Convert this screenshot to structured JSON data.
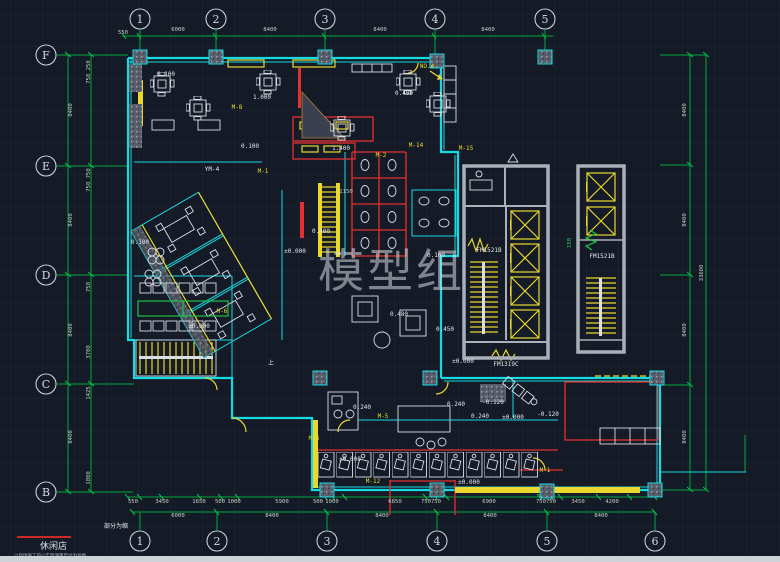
{
  "meta": {
    "watermark": "模型组",
    "note_bottom": "部分为缩",
    "title": "休闲店",
    "subtitle": "以现场施工前以实际测量尺寸为准图",
    "colors": {
      "background": "#141a26",
      "dim_green": "#00a83c",
      "wall_cyan": "#16dbe3",
      "fixture_yellow": "#ead82e",
      "accent_red": "#e23131",
      "text_white": "#e3e7ee"
    }
  },
  "axes": {
    "top": [
      {
        "label": "1",
        "x": 140
      },
      {
        "label": "2",
        "x": 216
      },
      {
        "label": "3",
        "x": 325
      },
      {
        "label": "4",
        "x": 435
      },
      {
        "label": "5",
        "x": 545
      }
    ],
    "bottom": [
      {
        "label": "1",
        "x": 140
      },
      {
        "label": "2",
        "x": 217
      },
      {
        "label": "3",
        "x": 327
      },
      {
        "label": "4",
        "x": 437
      },
      {
        "label": "5",
        "x": 547
      },
      {
        "label": "6",
        "x": 655
      }
    ],
    "left": [
      {
        "label": "F",
        "y": 55
      },
      {
        "label": "E",
        "y": 166
      },
      {
        "label": "D",
        "y": 275
      },
      {
        "label": "C",
        "y": 384
      },
      {
        "label": "B",
        "y": 492
      }
    ]
  },
  "dim_texts": [
    {
      "t": "550",
      "x": 123,
      "y": 34
    },
    {
      "t": "6000",
      "x": 178,
      "y": 31
    },
    {
      "t": "8400",
      "x": 270,
      "y": 31
    },
    {
      "t": "8400",
      "x": 380,
      "y": 31
    },
    {
      "t": "8400",
      "x": 488,
      "y": 31
    },
    {
      "t": "8400",
      "x": 686,
      "y": 110,
      "r": -90
    },
    {
      "t": "8400",
      "x": 686,
      "y": 220,
      "r": -90
    },
    {
      "t": "8400",
      "x": 686,
      "y": 330,
      "r": -90
    },
    {
      "t": "8400",
      "x": 686,
      "y": 437,
      "r": -90
    },
    {
      "t": "33600",
      "x": 703,
      "y": 273,
      "r": -90
    },
    {
      "t": "8400",
      "x": 72,
      "y": 110,
      "r": -90
    },
    {
      "t": "8400",
      "x": 72,
      "y": 220,
      "r": -90
    },
    {
      "t": "8400",
      "x": 72,
      "y": 330,
      "r": -90
    },
    {
      "t": "8400",
      "x": 72,
      "y": 437,
      "r": -90
    },
    {
      "t": "750 250",
      "x": 90,
      "y": 72,
      "r": -90
    },
    {
      "t": "750 750",
      "x": 90,
      "y": 180,
      "r": -90
    },
    {
      "t": "750",
      "x": 90,
      "y": 287,
      "r": -90
    },
    {
      "t": "3700",
      "x": 90,
      "y": 352,
      "r": -90
    },
    {
      "t": "1425",
      "x": 90,
      "y": 393,
      "r": -90
    },
    {
      "t": "1000",
      "x": 90,
      "y": 478,
      "r": -90
    },
    {
      "t": "550",
      "x": 133,
      "y": 503
    },
    {
      "t": "3450",
      "x": 162,
      "y": 503
    },
    {
      "t": "1650",
      "x": 199,
      "y": 503
    },
    {
      "t": "500",
      "x": 220,
      "y": 503
    },
    {
      "t": "1000",
      "x": 234,
      "y": 503
    },
    {
      "t": "5900",
      "x": 282,
      "y": 503
    },
    {
      "t": "500",
      "x": 318,
      "y": 503
    },
    {
      "t": "1000",
      "x": 332,
      "y": 503
    },
    {
      "t": "6850",
      "x": 395,
      "y": 503
    },
    {
      "t": "750",
      "x": 426,
      "y": 503
    },
    {
      "t": "750",
      "x": 436,
      "y": 503
    },
    {
      "t": "6900",
      "x": 489,
      "y": 503
    },
    {
      "t": "750",
      "x": 541,
      "y": 503
    },
    {
      "t": "750",
      "x": 551,
      "y": 503
    },
    {
      "t": "3450",
      "x": 578,
      "y": 503
    },
    {
      "t": "4200",
      "x": 612,
      "y": 503
    },
    {
      "t": "6000",
      "x": 178,
      "y": 517
    },
    {
      "t": "8400",
      "x": 272,
      "y": 517
    },
    {
      "t": "8400",
      "x": 382,
      "y": 517
    },
    {
      "t": "8400",
      "x": 490,
      "y": 517
    },
    {
      "t": "8400",
      "x": 601,
      "y": 517
    },
    {
      "t": "150",
      "x": 571,
      "y": 243,
      "r": -90,
      "c": "g"
    },
    {
      "t": "1150",
      "x": 346,
      "y": 193
    }
  ],
  "labels": [
    {
      "t": "0.100",
      "x": 166,
      "y": 76
    },
    {
      "t": "1.000",
      "x": 262,
      "y": 99
    },
    {
      "t": "0.400",
      "x": 404,
      "y": 95
    },
    {
      "t": "NO.4",
      "x": 427,
      "y": 68,
      "c": "y"
    },
    {
      "t": "0.100",
      "x": 140,
      "y": 244
    },
    {
      "t": "0.100",
      "x": 250,
      "y": 148
    },
    {
      "t": "1.400",
      "x": 341,
      "y": 150
    },
    {
      "t": "M-2",
      "x": 381,
      "y": 157,
      "c": "y"
    },
    {
      "t": "M-14",
      "x": 416,
      "y": 147,
      "c": "y"
    },
    {
      "t": "M-8",
      "x": 237,
      "y": 109,
      "c": "y"
    },
    {
      "t": "YM-4",
      "x": 212,
      "y": 171
    },
    {
      "t": "M-1",
      "x": 263,
      "y": 173,
      "c": "y"
    },
    {
      "t": "0.400",
      "x": 321,
      "y": 233
    },
    {
      "t": "±0.000",
      "x": 295,
      "y": 253
    },
    {
      "t": "0.100",
      "x": 436,
      "y": 257
    },
    {
      "t": "M-15",
      "x": 466,
      "y": 150,
      "c": "y"
    },
    {
      "t": "0.480",
      "x": 399,
      "y": 316
    },
    {
      "t": "0.450",
      "x": 445,
      "y": 331
    },
    {
      "t": "±0.000",
      "x": 199,
      "y": 328
    },
    {
      "t": "M-6",
      "x": 222,
      "y": 313,
      "c": "y"
    },
    {
      "t": "FM1521B",
      "x": 489,
      "y": 252
    },
    {
      "t": "FM1521B",
      "x": 602,
      "y": 258
    },
    {
      "t": "FM1319C",
      "x": 506,
      "y": 366
    },
    {
      "t": "±0.000",
      "x": 463,
      "y": 363
    },
    {
      "t": "0.240",
      "x": 362,
      "y": 409
    },
    {
      "t": "0.240",
      "x": 456,
      "y": 406
    },
    {
      "t": "-0.120",
      "x": 493,
      "y": 404
    },
    {
      "t": "0.240",
      "x": 480,
      "y": 418
    },
    {
      "t": "±0.000",
      "x": 513,
      "y": 419
    },
    {
      "t": "-0.120",
      "x": 548,
      "y": 416
    },
    {
      "t": "±0.000",
      "x": 350,
      "y": 461
    },
    {
      "t": "M-12",
      "x": 373,
      "y": 483,
      "c": "y"
    },
    {
      "t": "M-5",
      "x": 383,
      "y": 418,
      "c": "y"
    },
    {
      "t": "M-1",
      "x": 545,
      "y": 472,
      "c": "y"
    },
    {
      "t": "M-6",
      "x": 314,
      "y": 440,
      "c": "y"
    },
    {
      "t": "±0.000",
      "x": 469,
      "y": 484
    },
    {
      "t": "上",
      "x": 271,
      "y": 365
    },
    {
      "t": "部分为缩",
      "x": 116,
      "y": 528
    }
  ],
  "columns": [
    [
      140,
      57
    ],
    [
      216,
      57
    ],
    [
      325,
      57
    ],
    [
      437,
      61
    ],
    [
      545,
      57
    ],
    [
      320,
      378
    ],
    [
      430,
      378
    ],
    [
      327,
      490
    ],
    [
      437,
      490
    ],
    [
      547,
      491
    ],
    [
      655,
      490
    ],
    [
      657,
      378
    ]
  ]
}
